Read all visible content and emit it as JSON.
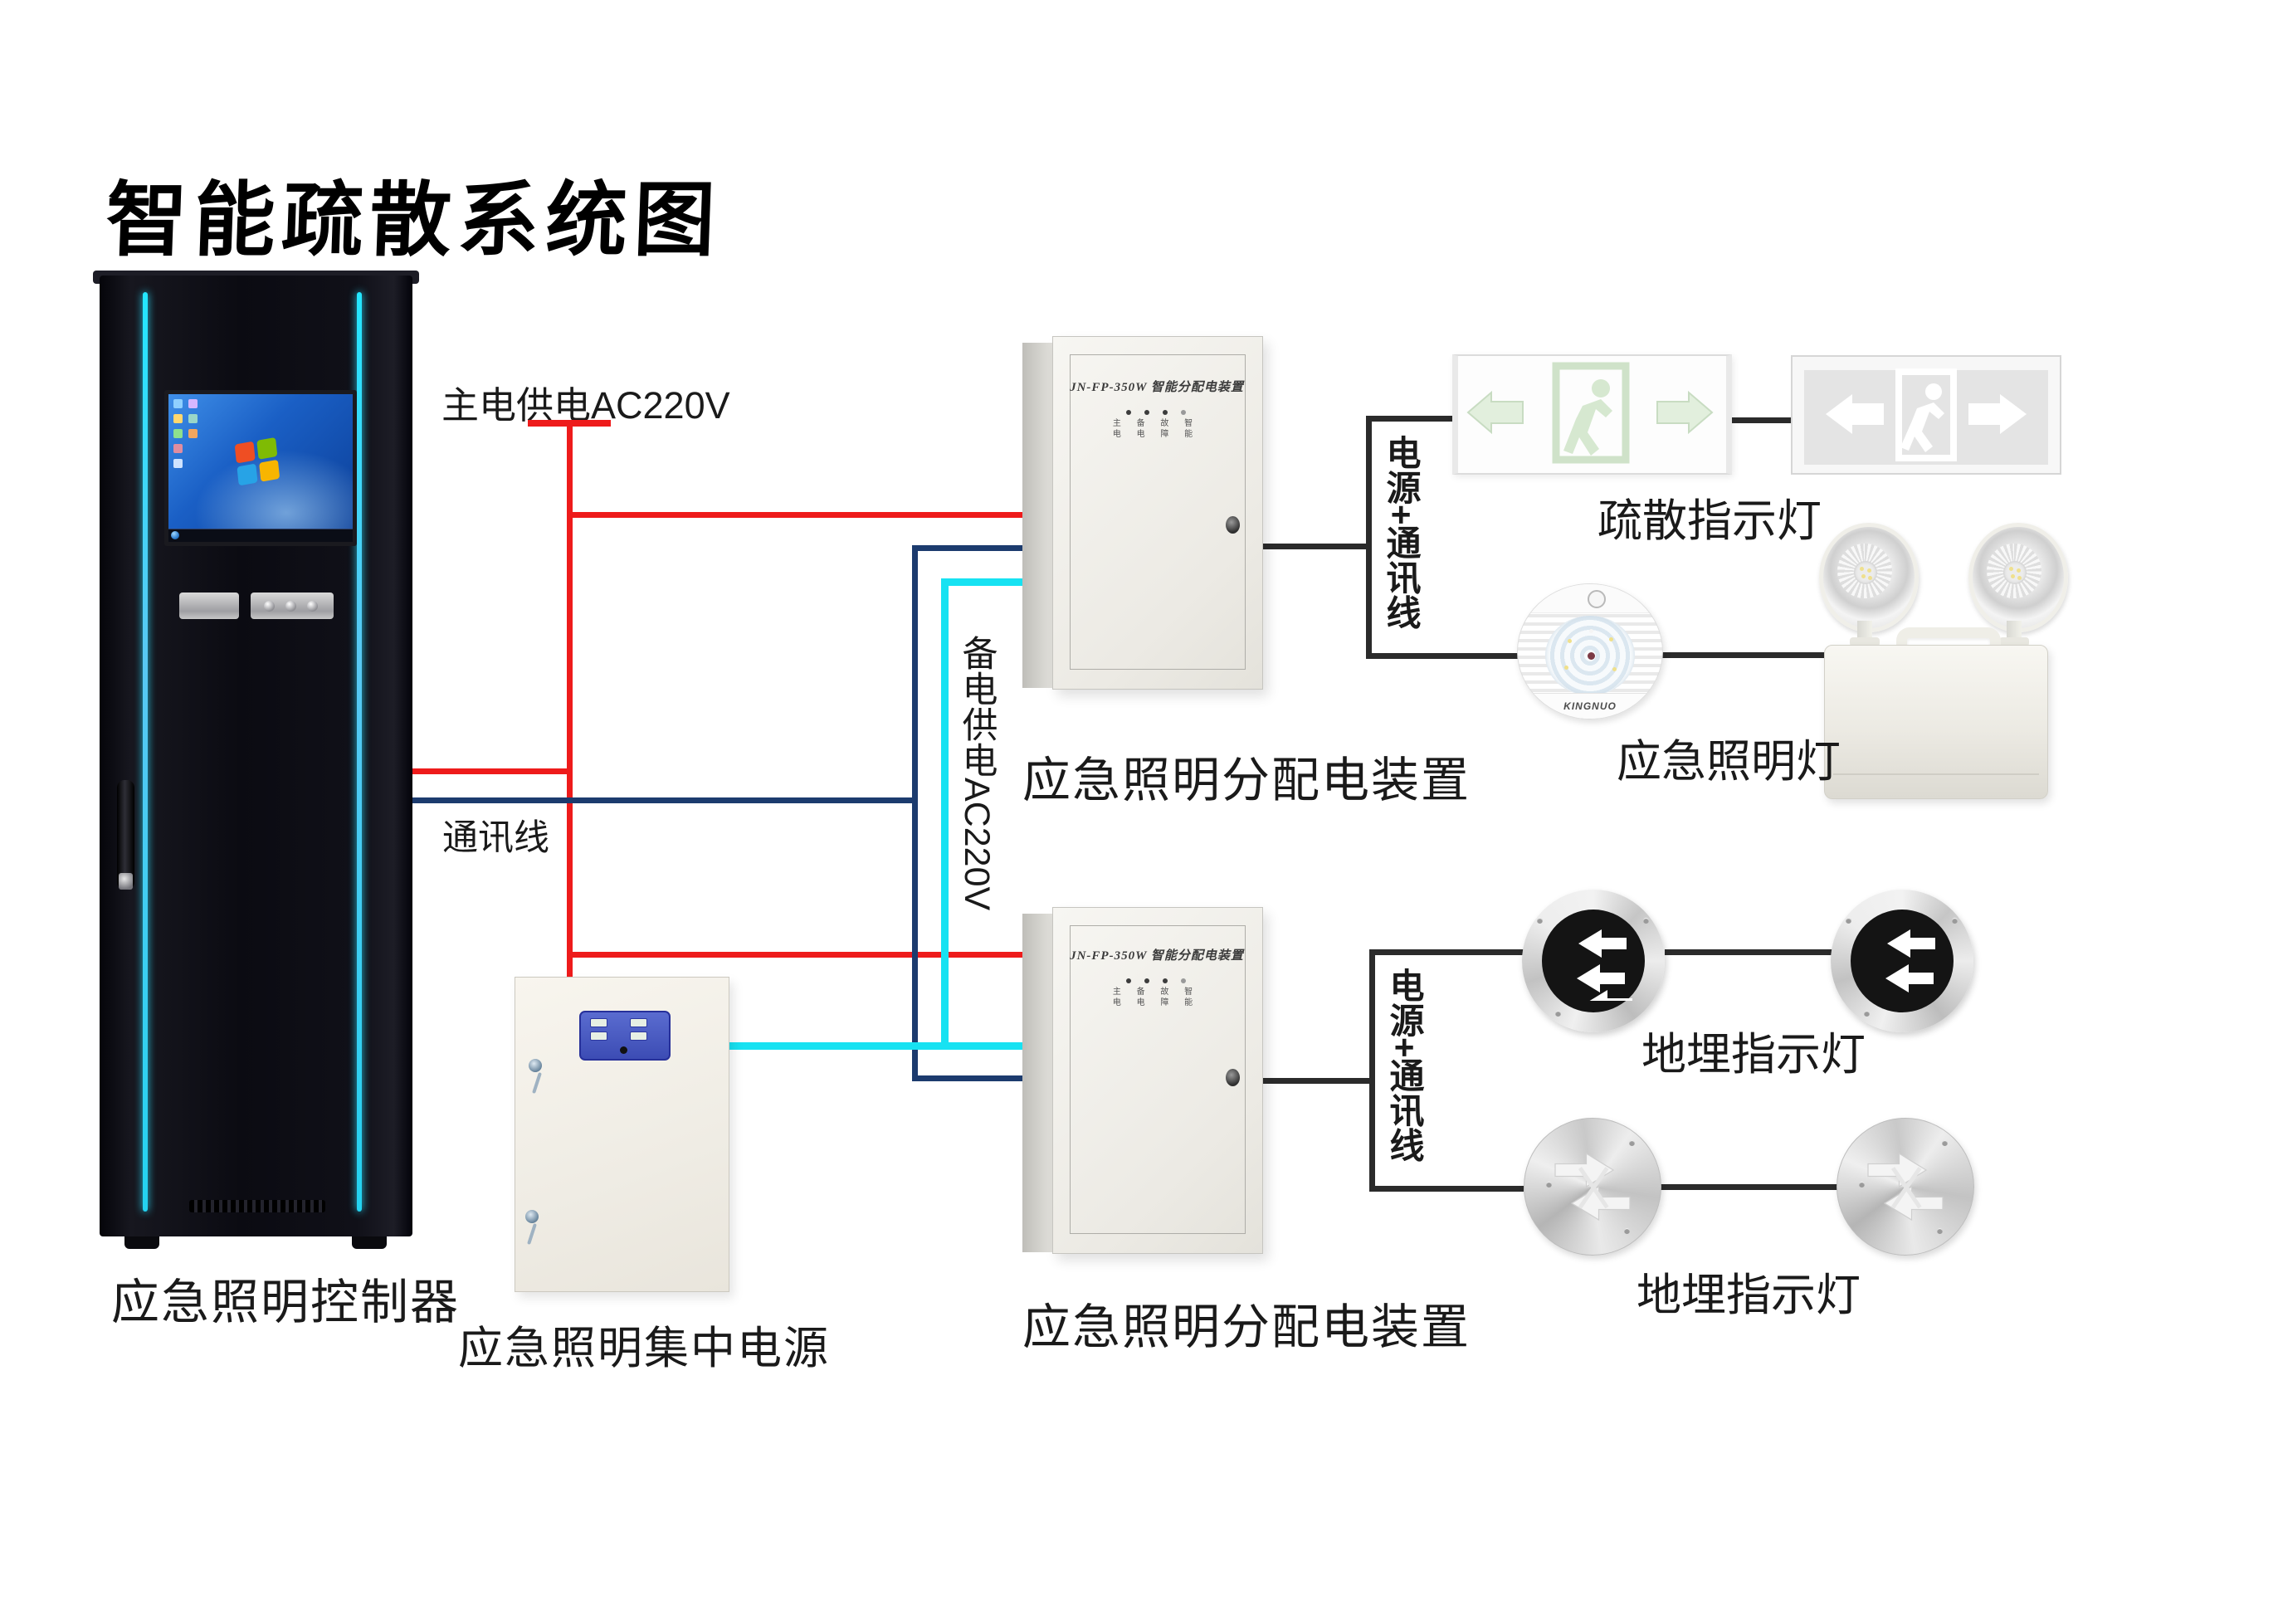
{
  "title": "智能疏散系统图",
  "wires": {
    "main_power_label": "主电供电AC220V",
    "comm_label": "通讯线",
    "backup_power_label": "备电供电AC220V",
    "power_comm_label_1": "电源+通讯线",
    "power_comm_label_2": "电源+通讯线",
    "colors": {
      "main_power": "#ee1b1b",
      "communication": "#1c3b6e",
      "backup_power": "#17e2f2",
      "device_link": "#2b2b2b"
    }
  },
  "devices": {
    "controller": {
      "label": "应急照明控制器"
    },
    "central_power": {
      "label": "应急照明集中电源"
    },
    "dist_box_1": {
      "label": "应急照明分配电装置",
      "print": "JN-FP-350W 智能分配电装置",
      "indicator_row_1": "主 备 故 智",
      "indicator_row_2": "电 电 障 能"
    },
    "dist_box_2": {
      "label": "应急照明分配电装置",
      "print": "JN-FP-350W 智能分配电装置",
      "indicator_row_1": "主 备 故 智",
      "indicator_row_2": "电 电 障 能"
    },
    "evac_signs": {
      "label": "疏散指示灯"
    },
    "emergency_lights": {
      "label": "应急照明灯",
      "round_light_brand": "KINGNUO"
    },
    "ground_lights_row1": {
      "label": "地埋指示灯"
    },
    "ground_lights_row2": {
      "label": "地埋指示灯"
    }
  }
}
